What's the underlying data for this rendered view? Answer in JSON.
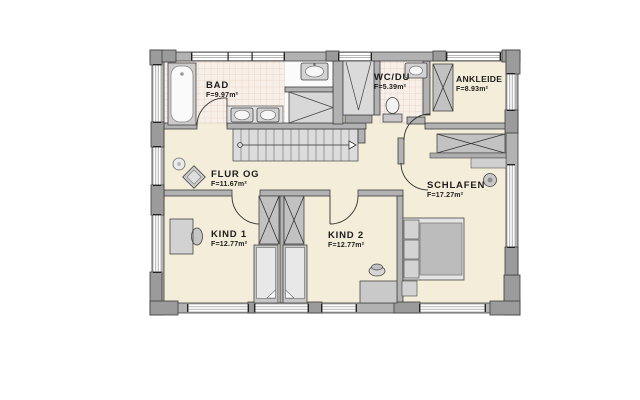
{
  "colors": {
    "wall": "#b2b2b2",
    "floor": "#f4edda",
    "bath_tile": "#f8f0e8",
    "tile_line": "#e2cdbf",
    "furniture": "#d6d6d6",
    "text": "#1c1c1c"
  },
  "rooms": {
    "bad": {
      "name": "BAD",
      "area": "F=9.97m²"
    },
    "wc": {
      "name": "WC/DU",
      "area": "F=5.39m²"
    },
    "ankleide": {
      "name": "ANKLEIDE",
      "area": "F=8.93m²"
    },
    "flur": {
      "name": "FLUR OG",
      "area": "F=11.67m²"
    },
    "schlafen": {
      "name": "SCHLAFEN",
      "area": "F=17.27m²"
    },
    "kind1": {
      "name": "KIND 1",
      "area": "F=12.77m²"
    },
    "kind2": {
      "name": "KIND 2",
      "area": "F=12.77m²"
    }
  }
}
